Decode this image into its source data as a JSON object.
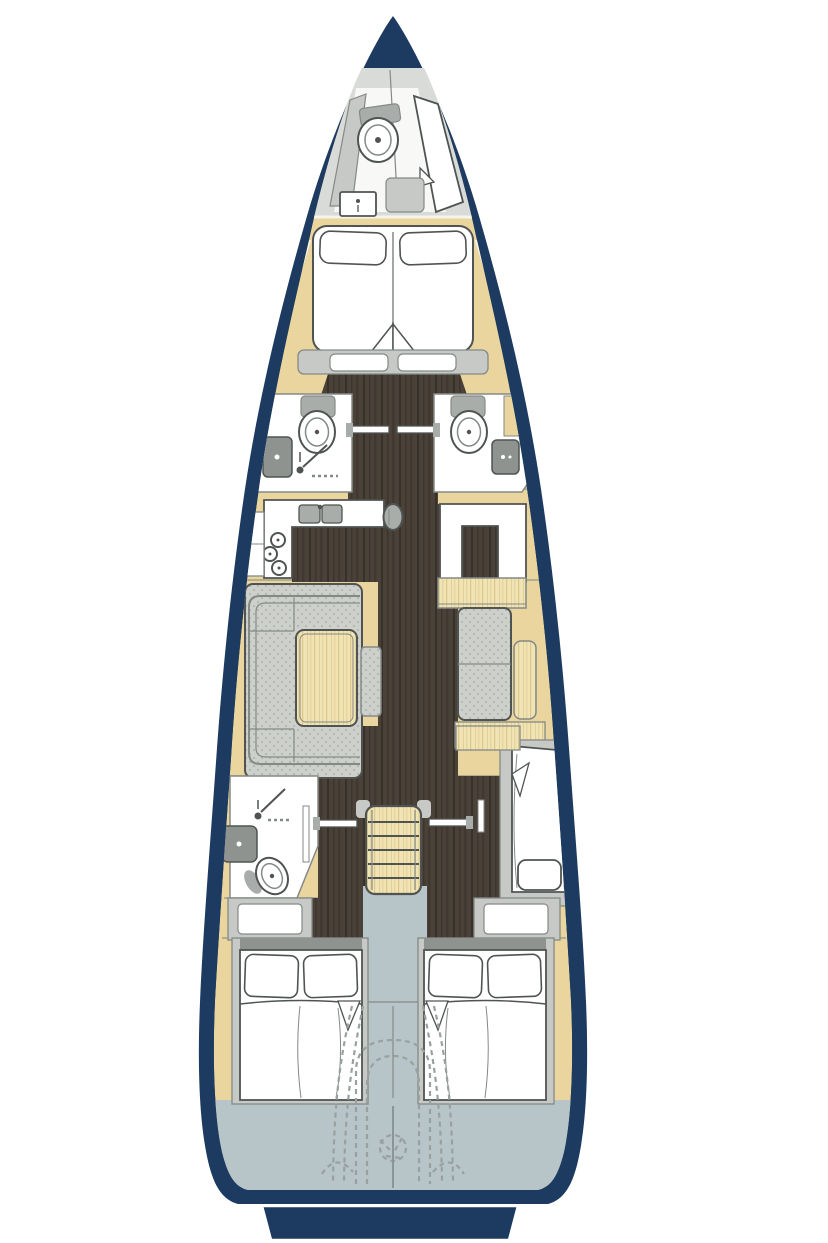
{
  "palette": {
    "page_bg": "#ffffff",
    "hull_navy": "#1d3b60",
    "deck_tan": "#e9d59d",
    "plank_light": "#f0e3b4",
    "plank_grain": "#d9c183",
    "floor_dark": "#4a4138",
    "floor_grain": "#37312a",
    "bow_gray": "#d9dbd8",
    "furniture_gray": "#c6c9c5",
    "fabric_gray": "#cdd0cb",
    "fabric_dot": "#b3b6b1",
    "fixture_gray": "#a8adaa",
    "sink_dark": "#8e938f",
    "aft_blue": "#b7c5c8",
    "white": "#ffffff",
    "outline": "#4f5452",
    "outline_soft": "#848a86",
    "dash_gray": "#99a0a0"
  },
  "icons": {
    "toilet": "double-oval-with-dot",
    "washbasin": "rounded-square-with-dot",
    "shower": "dot-with-diagonal-spray-line",
    "stove": "three-burner-rings",
    "galley_sink": "twin-rectangles-with-faucet-dot",
    "companionway_stairs": "ladder-rungs",
    "mast": "gray-oval",
    "steering_gear": "dashed-outlines",
    "swim_platform": "stern-bar"
  }
}
